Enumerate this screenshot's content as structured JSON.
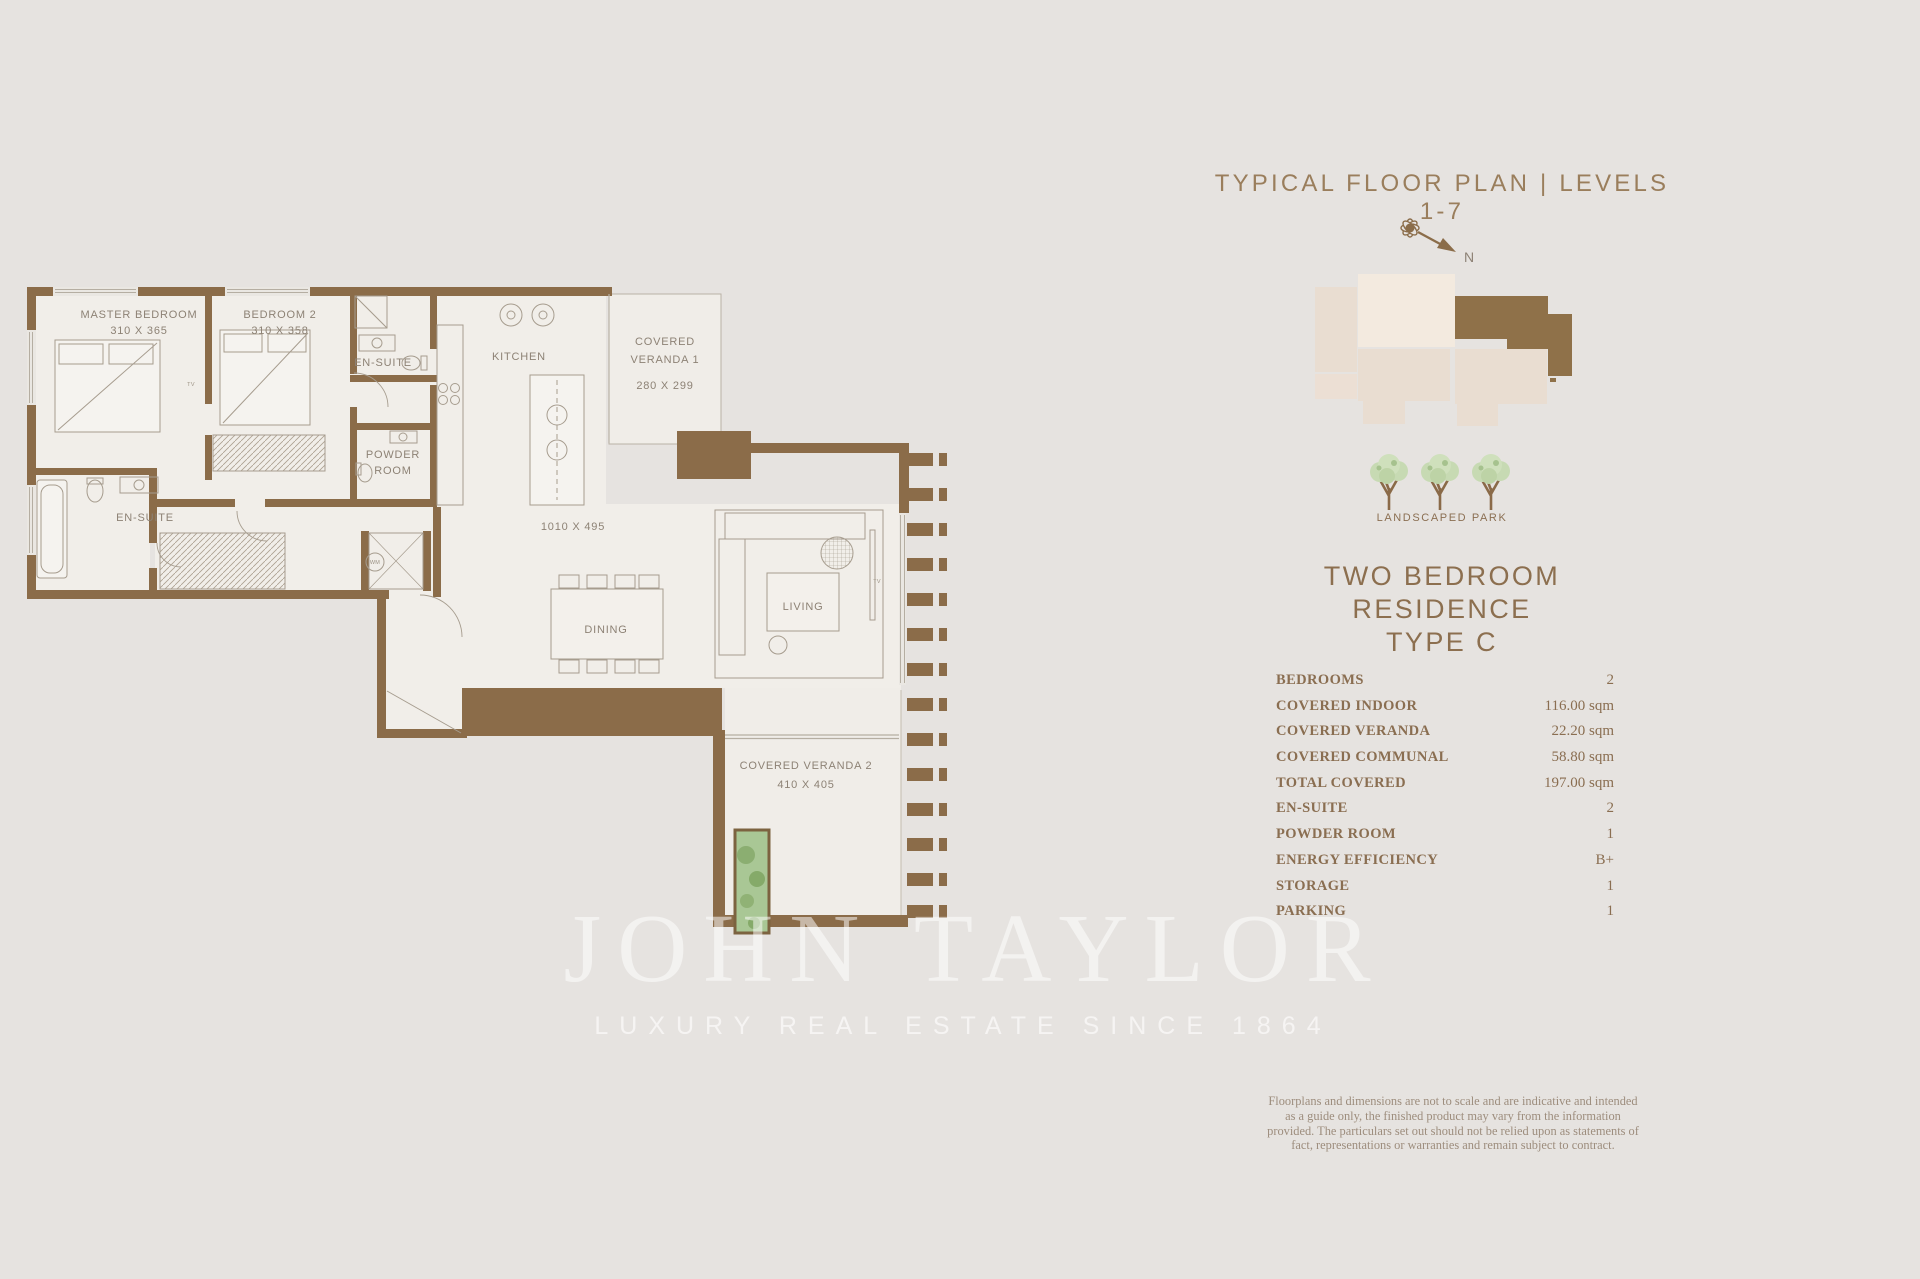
{
  "header": {
    "title": "TYPICAL FLOOR PLAN | LEVELS 1-7"
  },
  "compass": {
    "north_label": "N"
  },
  "park": {
    "label": "LANDSCAPED PARK"
  },
  "residence": {
    "line1": "TWO BEDROOM RESIDENCE",
    "line2": "TYPE C"
  },
  "specs": [
    {
      "label": "BEDROOMS",
      "value": "2"
    },
    {
      "label": "COVERED INDOOR",
      "value": "116.00 sqm"
    },
    {
      "label": "COVERED VERANDA",
      "value": "22.20 sqm"
    },
    {
      "label": "COVERED COMMUNAL",
      "value": "58.80 sqm"
    },
    {
      "label": "TOTAL COVERED",
      "value": "197.00 sqm"
    },
    {
      "label": "EN-SUITE",
      "value": "2"
    },
    {
      "label": "POWDER ROOM",
      "value": "1"
    },
    {
      "label": "ENERGY EFFICIENCY",
      "value": "B+"
    },
    {
      "label": "STORAGE",
      "value": "1"
    },
    {
      "label": "PARKING",
      "value": "1"
    }
  ],
  "disclaimer": "Floorplans and dimensions are not to scale and are indicative and intended as a guide only, the finished product may vary from the information provided. The particulars set out should not be relied upon as statements of fact, representations or warranties and remain subject to contract.",
  "watermark": {
    "name": "JOHN TAYLOR",
    "tagline": "LUXURY REAL ESTATE SINCE 1864"
  },
  "floorplan": {
    "labels": {
      "master": "MASTER BEDROOM",
      "master_dims": "310 X 365",
      "bedroom2": "BEDROOM 2",
      "bedroom2_dims": "310 X 358",
      "ensuite_top": "EN-SUITE",
      "powder_l1": "POWDER",
      "powder_l2": "ROOM",
      "kitchen": "KITCHEN",
      "veranda1_l1": "COVERED",
      "veranda1_l2": "VERANDA 1",
      "veranda1_dims": "280 X 299",
      "open_dims": "1010 X 495",
      "ensuite_left": "EN-SUITE",
      "dining": "DINING",
      "living": "LIVING",
      "veranda2": "COVERED VERANDA 2",
      "veranda2_dims": "410 X 405",
      "tv": "TV",
      "wm": "WM"
    }
  },
  "colors": {
    "background": "#e6e3e0",
    "wall_brown": "#8b6c49",
    "floor": "#f1eee9",
    "accent_title": "#9a7e5c",
    "keyplan_highlight": "#8f7149",
    "keyplan_light": "#e9ddd1",
    "keyplan_cream": "#f3eadf",
    "tree_green": "#c7dab3",
    "planter_green": "#a9c795"
  }
}
